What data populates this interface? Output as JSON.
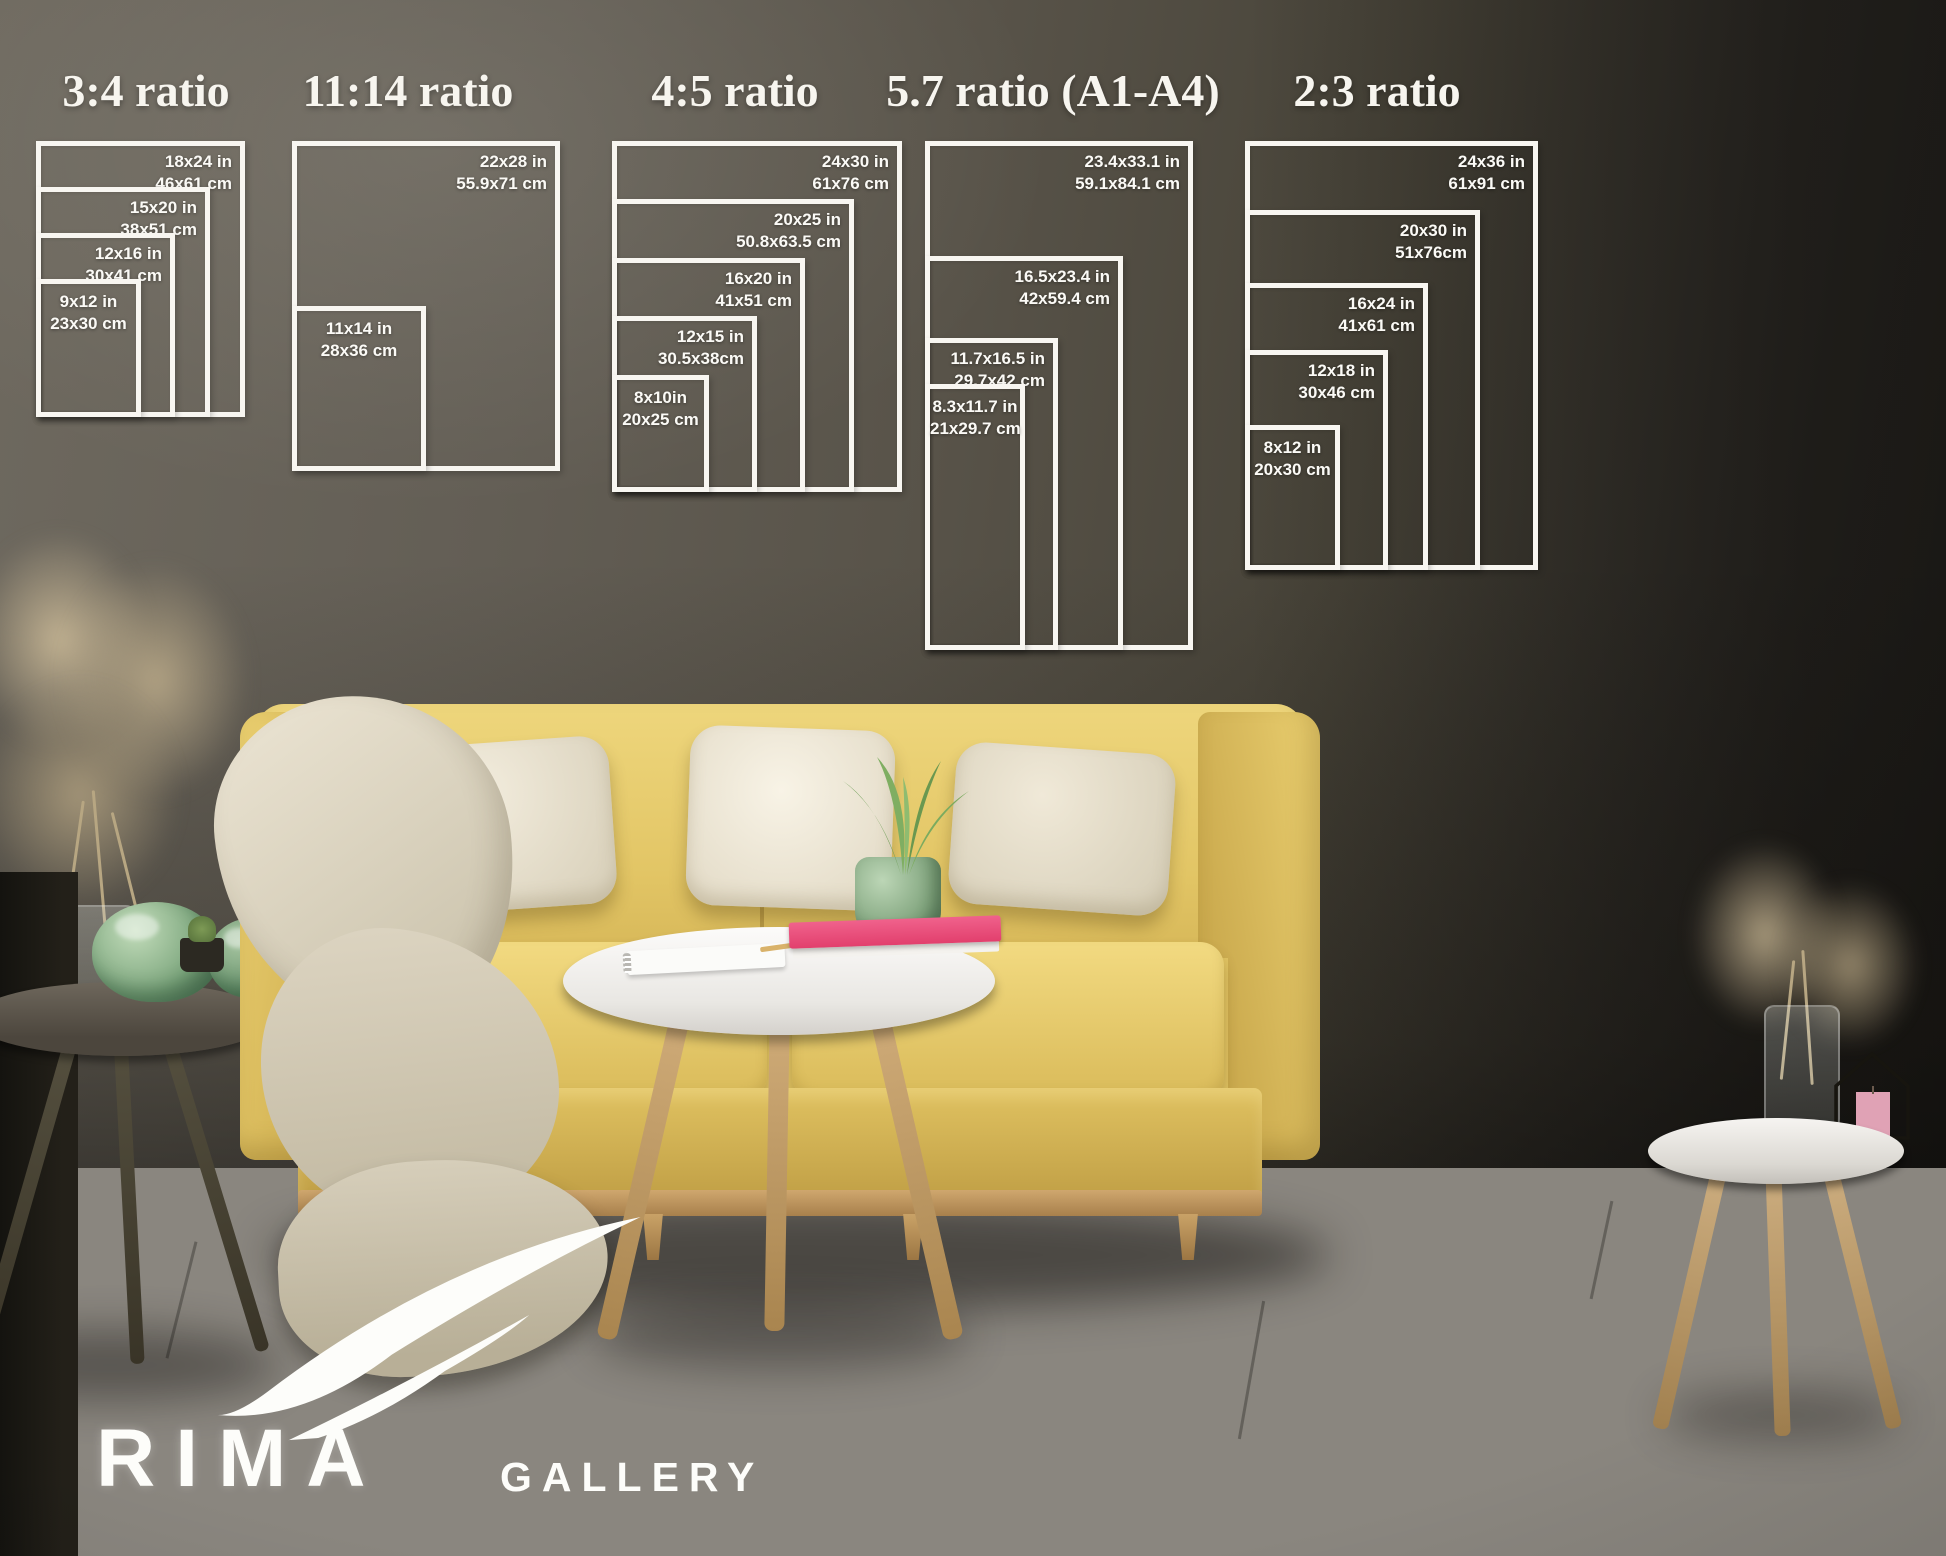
{
  "scene": {
    "size_guide_title": "SIZE GUIDE",
    "sofa_width_note": "sofa is 85 in (215 cm ) wide",
    "brand": {
      "name": "RIMA",
      "suffix": "GALLERY"
    }
  },
  "icons": {
    "sofa_width_left": "arrow-left",
    "sofa_width_right": "arrow-right",
    "brand_mark": "double-swoosh"
  },
  "colors": {
    "diagram_line": "#f8f6f1",
    "wall_left": "#6e695f",
    "wall_right": "#211f1b",
    "sofa_yellow": "#e2c565",
    "pillow_cream": "#ede6d4",
    "book_pink": "#e8436e",
    "plant_green": "#7fa37c",
    "floor_gray": "#8a867f"
  },
  "ratio_groups": [
    {
      "title": "3:4 ratio",
      "sizes": [
        {
          "in": "18x24 in",
          "cm": "46x61 cm"
        },
        {
          "in": "15x20 in",
          "cm": "38x51 cm"
        },
        {
          "in": "12x16 in",
          "cm": "30x41 cm"
        },
        {
          "in": "9x12 in",
          "cm": "23x30 cm"
        }
      ]
    },
    {
      "title": "11:14 ratio",
      "sizes": [
        {
          "in": "22x28 in",
          "cm": "55.9x71 cm"
        },
        {
          "in": "11x14 in",
          "cm": "28x36 cm"
        }
      ]
    },
    {
      "title": "4:5 ratio",
      "sizes": [
        {
          "in": "24x30 in",
          "cm": "61x76 cm"
        },
        {
          "in": "20x25 in",
          "cm": "50.8x63.5 cm"
        },
        {
          "in": "16x20 in",
          "cm": "41x51 cm"
        },
        {
          "in": "12x15 in",
          "cm": "30.5x38cm"
        },
        {
          "in": "8x10in",
          "cm": "20x25 cm"
        }
      ]
    },
    {
      "title": "5.7 ratio (A1-A4)",
      "sizes": [
        {
          "in": "23.4x33.1 in",
          "cm": "59.1x84.1 cm"
        },
        {
          "in": "16.5x23.4 in",
          "cm": "42x59.4 cm"
        },
        {
          "in": "11.7x16.5 in",
          "cm": "29.7x42 cm"
        },
        {
          "in": "8.3x11.7 in",
          "cm": "21x29.7 cm"
        }
      ]
    },
    {
      "title": "2:3 ratio",
      "sizes": [
        {
          "in": "24x36 in",
          "cm": "61x91 cm"
        },
        {
          "in": "20x30 in",
          "cm": "51x76cm"
        },
        {
          "in": "16x24 in",
          "cm": "41x61 cm"
        },
        {
          "in": "12x18 in",
          "cm": "30x46 cm"
        },
        {
          "in": "8x12 in",
          "cm": "20x30 cm"
        }
      ]
    }
  ]
}
